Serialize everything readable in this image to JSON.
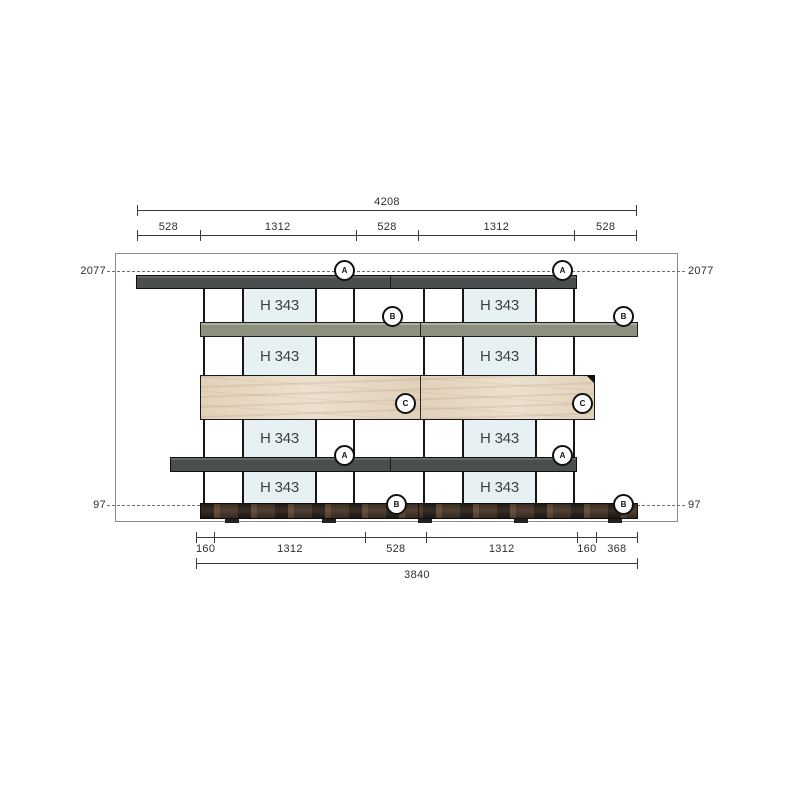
{
  "drawing": {
    "type": "furniture-elevation",
    "top_dimension_total": "4208",
    "top_dimension_segments": [
      "528",
      "1312",
      "528",
      "1312",
      "528"
    ],
    "bottom_dimension_segments": [
      "160",
      "1312",
      "528",
      "1312",
      "160",
      "368"
    ],
    "bottom_dimension_total": "3840",
    "height_labels": {
      "top_left": "2077",
      "top_right": "2077",
      "bottom_left": "97",
      "bottom_right": "97"
    },
    "panel_label": "H 343",
    "badges": {
      "shelf_a": "A",
      "shelf_b": "B",
      "panel_c": "C"
    },
    "colors": {
      "shelf-dark": "#4a4e4e",
      "shelf-green": "#8d907e",
      "panel-blue": "#e7f1f4",
      "wood-cream": "#eadfcc",
      "plinth-brown": "#453629"
    }
  }
}
